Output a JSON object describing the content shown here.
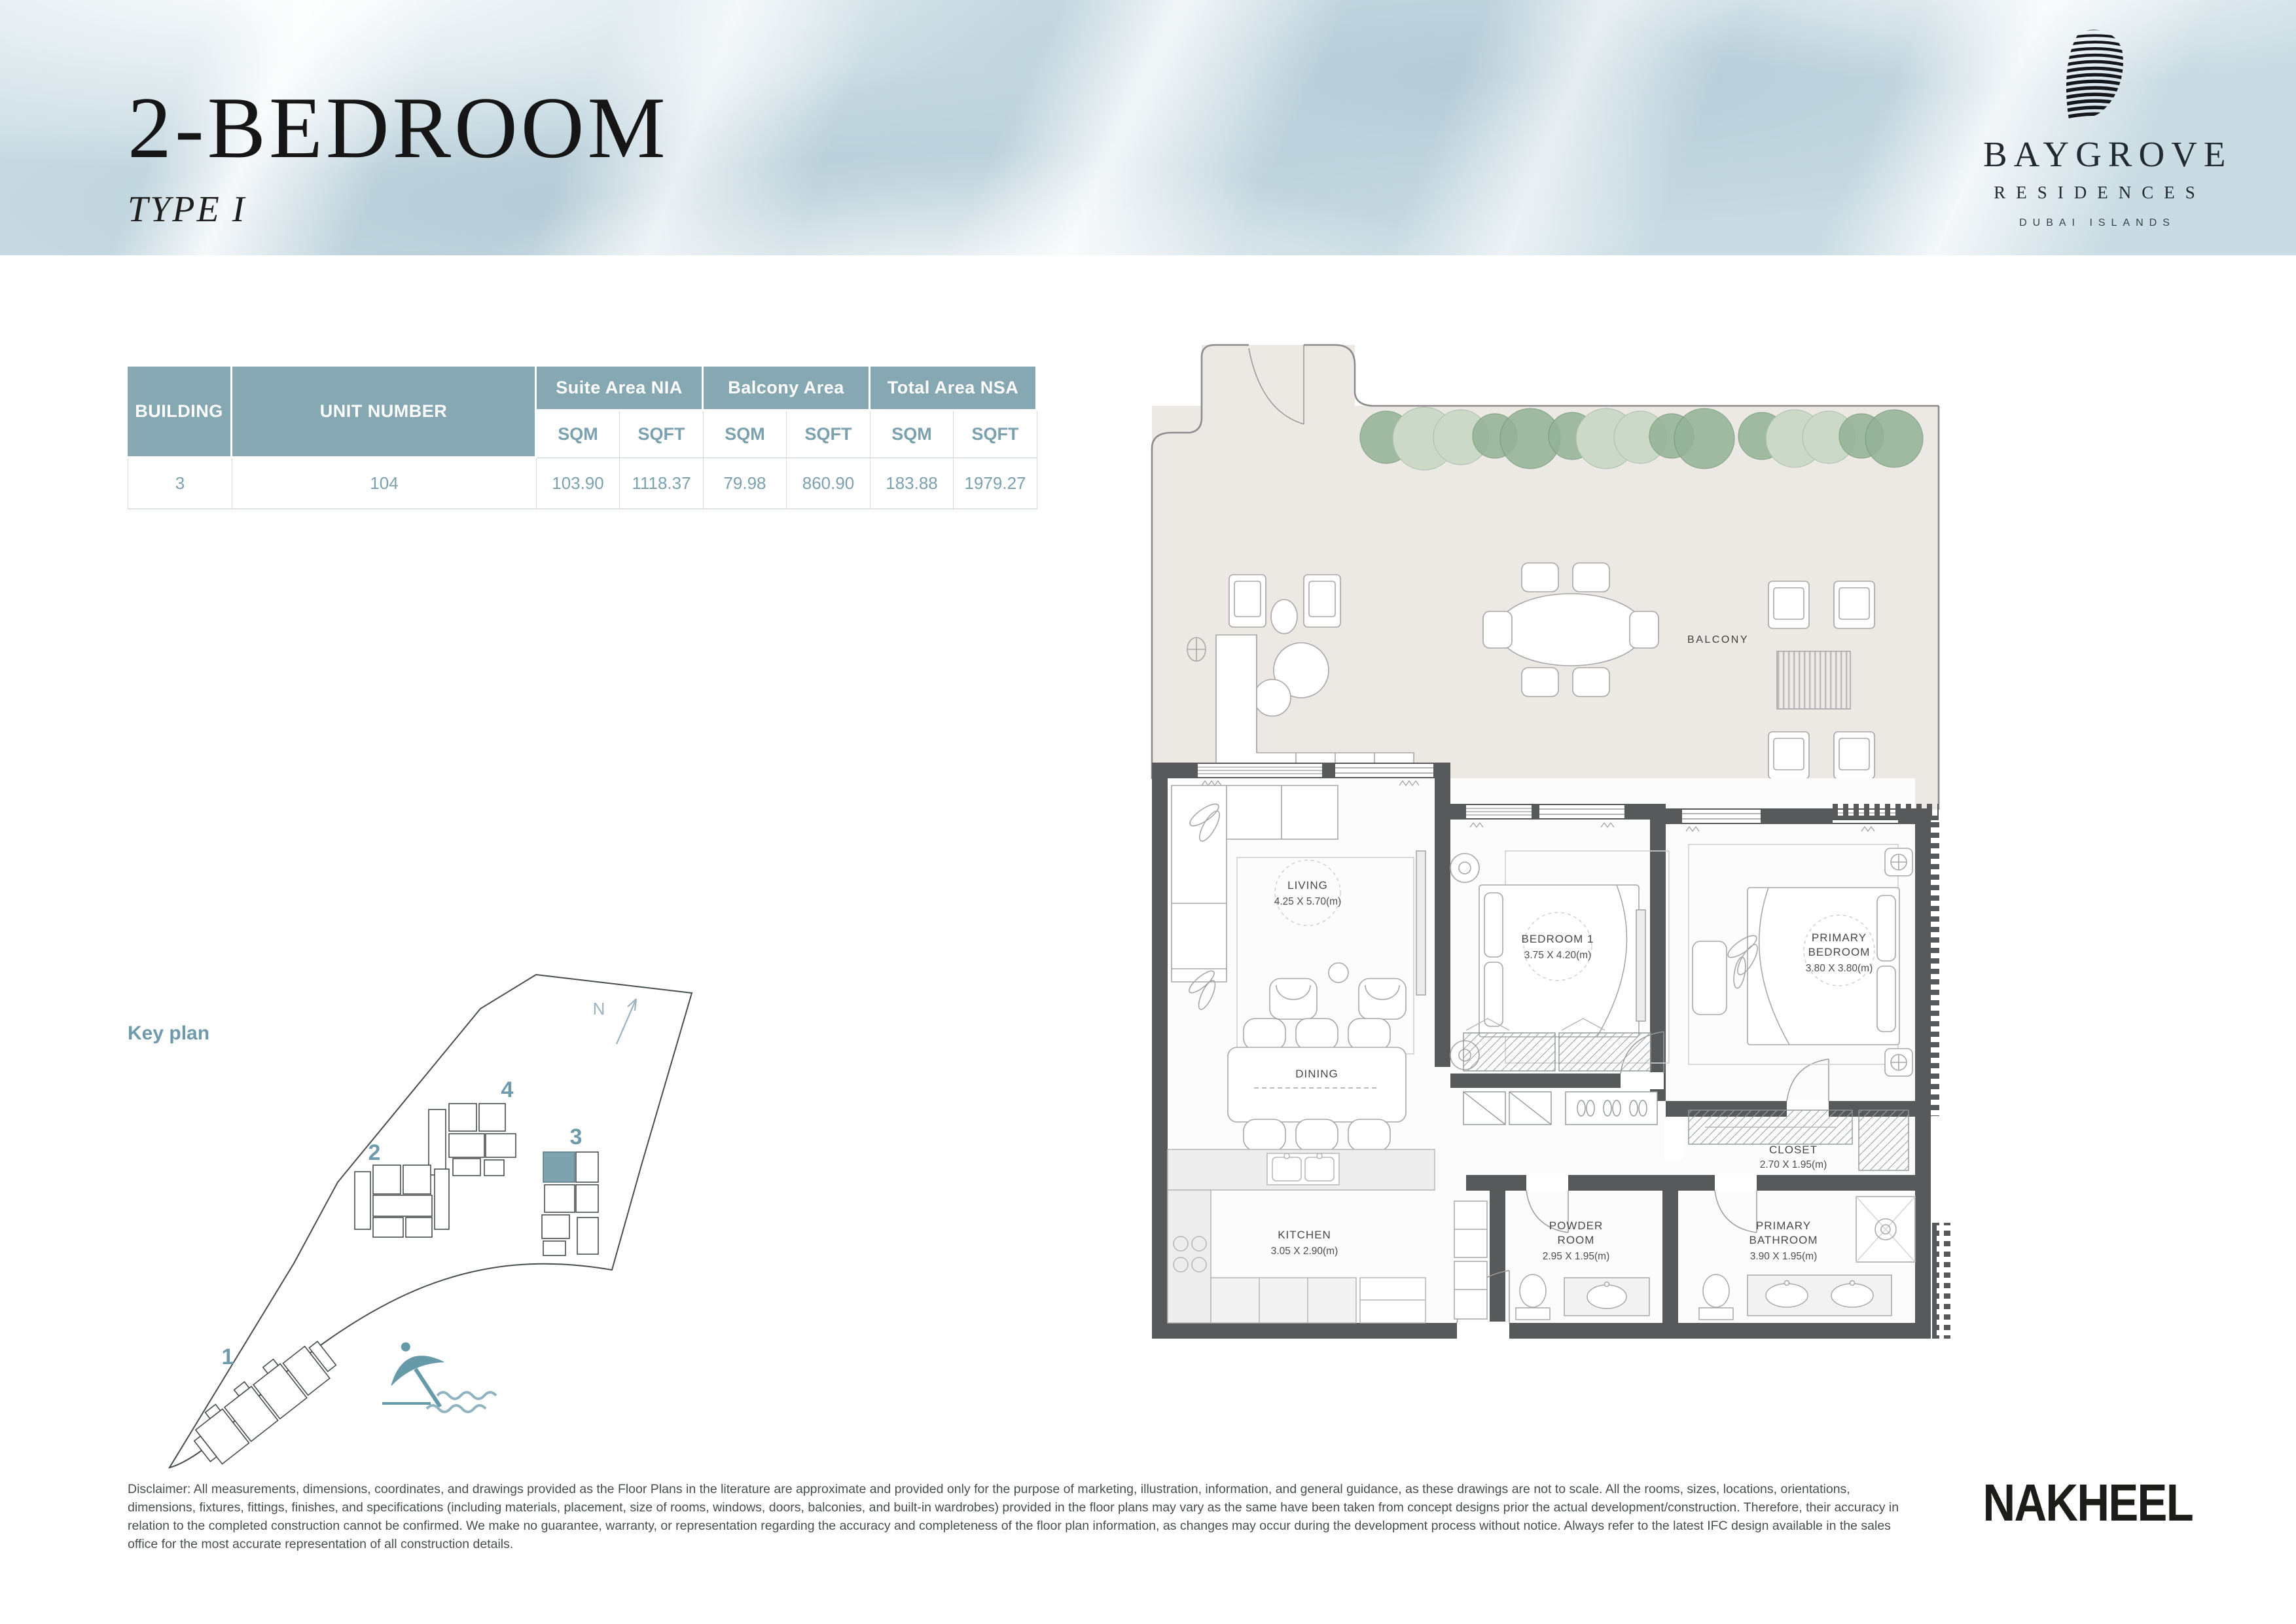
{
  "header": {
    "title": "2-BEDROOM",
    "subtitle": "TYPE I"
  },
  "brand": {
    "name": "BAYGROVE",
    "division": "RESIDENCES",
    "location": "DUBAI ISLANDS"
  },
  "area_table": {
    "col_building": "BUILDING",
    "col_unit": "UNIT NUMBER",
    "group_suite": "Suite Area NIA",
    "group_balcony": "Balcony Area",
    "group_total": "Total Area NSA",
    "sub_sqm": "SQM",
    "sub_sqft": "SQFT",
    "row": {
      "building": "3",
      "unit": "104",
      "suite_sqm": "103.90",
      "suite_sqft": "1118.37",
      "balcony_sqm": "79.98",
      "balcony_sqft": "860.90",
      "total_sqm": "183.88",
      "total_sqft": "1979.27"
    }
  },
  "key_plan": {
    "label": "Key plan",
    "north": "N",
    "building_1": "1",
    "building_2": "2",
    "building_3": "3",
    "building_4": "4"
  },
  "floor_plan": {
    "balcony": "BALCONY",
    "living_name": "LIVING",
    "living_dims": "4.25 X 5.70(m)",
    "bedroom1_name": "BEDROOM 1",
    "bedroom1_dims": "3.75 X 4.20(m)",
    "primary_name_1": "PRIMARY",
    "primary_name_2": "BEDROOM",
    "primary_dims": "3.80 X 3.80(m)",
    "dining_name": "DINING",
    "kitchen_name": "KITCHEN",
    "kitchen_dims": "3.05 X 2.90(m)",
    "powder_name_1": "POWDER",
    "powder_name_2": "ROOM",
    "powder_dims": "2.95 X 1.95(m)",
    "pbath_name_1": "PRIMARY",
    "pbath_name_2": "BATHROOM",
    "pbath_dims": "3.90 X 1.95(m)",
    "closet_name": "CLOSET",
    "closet_dims": "2.70 X 1.95(m)"
  },
  "disclaimer": "Disclaimer: All measurements, dimensions, coordinates, and drawings provided as the Floor Plans in the literature are approximate and provided only for the purpose of marketing, illustration, information, and general guidance, as these drawings are not to scale. All the rooms, sizes, locations, orientations, dimensions, fixtures, fittings, finishes, and specifications (including materials, placement, size of rooms, windows, doors, balconies, and built-in wardrobes) provided in the floor plans may vary as the same have been taken from concept designs prior the actual development/construction. Therefore, their accuracy in relation to the completed construction cannot be confirmed. We make no guarantee, warranty, or representation regarding the accuracy and completeness of the floor plan information, as changes may occur during the development process without notice. Always refer to the latest IFC design available in the sales office for the most accurate representation of all construction details.",
  "footer_brand": "NAKHEEL",
  "colors": {
    "table_teal": "#86a8b3",
    "teal_text": "#7ba1ae",
    "accent_teal": "#6f9aab",
    "wall_gray": "#58595b",
    "balcony_floor": "#ece8e4",
    "highlight_unit": "#7fa3ae"
  }
}
